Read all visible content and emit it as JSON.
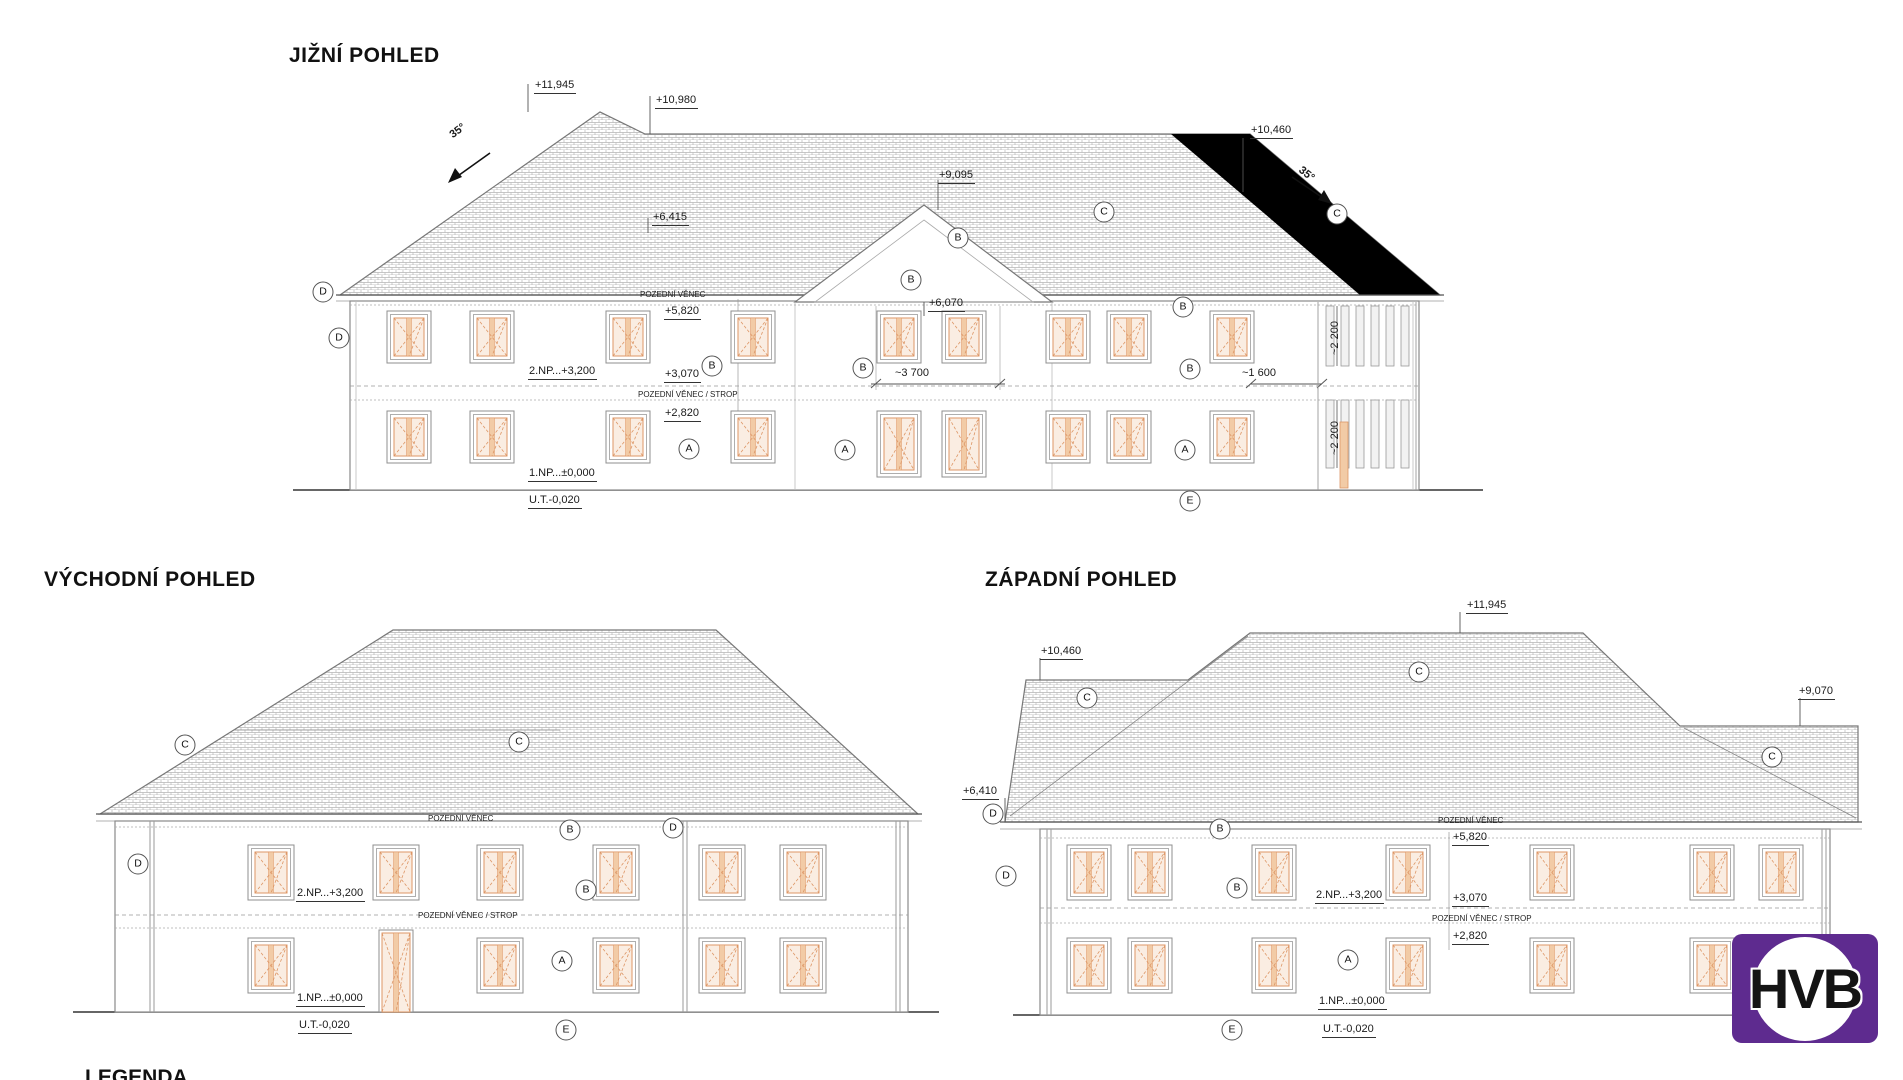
{
  "sheet": {
    "legend_title": "LEGENDA"
  },
  "titles": {
    "south": "JIŽNÍ POHLED",
    "east": "VÝCHODNÍ POHLED",
    "west": "ZÁPADNÍ POHLED"
  },
  "levels": {
    "p11945": "+11,945",
    "p10980": "+10,980",
    "p10460": "+10,460",
    "p9095": "+9,095",
    "p9070": "+9,070",
    "p6415": "+6,415",
    "p6410": "+6,410",
    "p6070": "+6,070",
    "p5820": "+5,820",
    "p3070": "+3,070",
    "p2820": "+2,820",
    "floor2": "2.NP...+3,200",
    "floor1": "1.NP...±0,000",
    "ut": "U.T.-0,020"
  },
  "notes": {
    "pozedni_venec": "POZEDNÍ VĚNEC",
    "pozedni_venec_strop": "POZEDNÍ VĚNEC / STROP",
    "slope": "35°"
  },
  "dims": {
    "d3700": "~3 700",
    "d1600": "~1 600",
    "d2200": "~2 200"
  },
  "bubbles": {
    "a": "A",
    "b": "B",
    "c": "C",
    "d": "D",
    "e": "E"
  },
  "logo": {
    "text": "HVB",
    "color": "#5E2B8F"
  },
  "colors": {
    "window_orange": "#DD9665",
    "window_glass": "#FAEDE2",
    "window_band": "#F2CBA6",
    "roof_hatch": "#B5B5B5",
    "black_roof": "#000000",
    "line": "#666666"
  }
}
